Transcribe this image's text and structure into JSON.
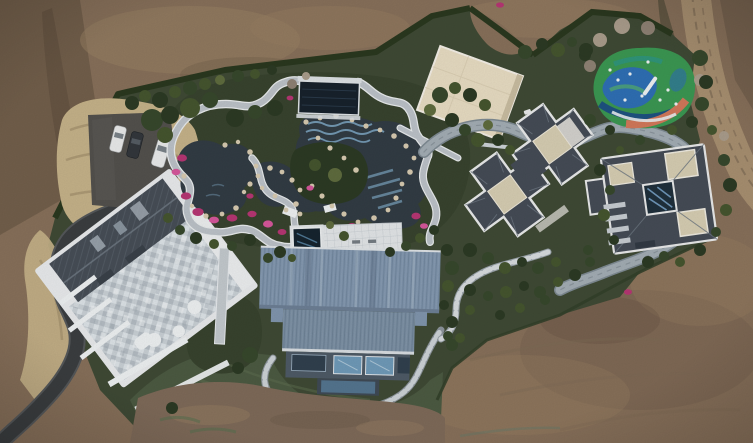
{
  "meta": {
    "title": "Aerial drone photograph of a landscaped estate compound",
    "caption": "Top-down aerial view of a private estate surrounded by bare earth: a central Japanese-style garden with ponds, winding stone paths and pink azaleas; a dark-navy pool pavilion; a large blue metal-roofed barn house; a tiled-roof main house with parking and three cars; two dark-roofed villas connected by a looping grey road; a colorful children's playground; hedge borders, lawns and dirt roads."
  },
  "scene": {
    "features": [
      "bare-dirt-terrain",
      "dirt-road-top-right",
      "hedge-border",
      "dry-grass-bank",
      "asphalt-driveway",
      "parking-pad",
      "three-parked-cars",
      "main-house-tiled-terrace",
      "white-retaining-walls",
      "garden-ponds",
      "stone-garden-paths",
      "pink-azalea-beds",
      "rock-edging",
      "pool-pavilion-navy-roof",
      "wave-pool",
      "white-terrace-and-plunge-pool",
      "construction-pad-cream",
      "looping-grey-road",
      "children-playground",
      "center-villa-cross-roof",
      "east-villa-pinwheel-roof",
      "blue-metal-barn-house",
      "stepping-stone-path",
      "lawn",
      "graded-dirt-patch",
      "shrubs-and-trees"
    ],
    "counts": {
      "cars": 3,
      "villas": 2,
      "ponds": 3
    }
  },
  "palette": {
    "dirt_base": "#87705a",
    "dirt_dark": "#6b5947",
    "dirt_light": "#9a8164",
    "dirt_ridge": "#5e4d3e",
    "dirt_road": "#a78f70",
    "dirt_track": "#7e6b55",
    "compound_green": "#3f4a35",
    "garden_green": "#38432e",
    "hedge": "#2a381f",
    "lawn": "#4c5a42",
    "lawn_light": "#5d6d50",
    "dirt_patch": "#7e6a59",
    "dry_grass": "#c5b289",
    "asphalt": "#3b3e40",
    "asphalt_edge": "#55585a",
    "parking": "#53514d",
    "water": "#323c44",
    "water_deep": "#16242f",
    "pool_stripe": "#7fa9c6",
    "path_stone": "#bcc2c8",
    "path_casing": "#e9eced",
    "loop_road": "#a3adb4",
    "loop_edge": "#7e8a92",
    "rock": "#d7cab0",
    "flower": "#b63673",
    "flower_light": "#d6579b",
    "navy_roof": "#18222c",
    "cream_pad": "#e7dcc2",
    "cream_flat": "#d6cdb2",
    "villa_roof": "#454c56",
    "villa_trim": "#e9eaea",
    "ridge_line": "#6c7680",
    "barn_roof": "#8095ad",
    "barn_roof_dark": "#6d7f95",
    "barn_wall": "#4e5a66",
    "glass_blue": "#6f9ab8",
    "terrace_white": "#e2e5e7",
    "shrub_dark": "#2c3a24",
    "shrub_mid": "#45552f",
    "shrub_light": "#5f6c3e",
    "shrub_alt": "#37482c",
    "bare_tree": "#a99c8b",
    "bare_tree2": "#8f8274",
    "car_white": "#e9eaea",
    "car_dark": "#33373c",
    "pg_green": "#3b9752",
    "pg_blue": "#2f6fb4",
    "pg_navy": "#1c4a85",
    "pg_orange": "#d2785a",
    "pg_teal": "#2f9480"
  }
}
